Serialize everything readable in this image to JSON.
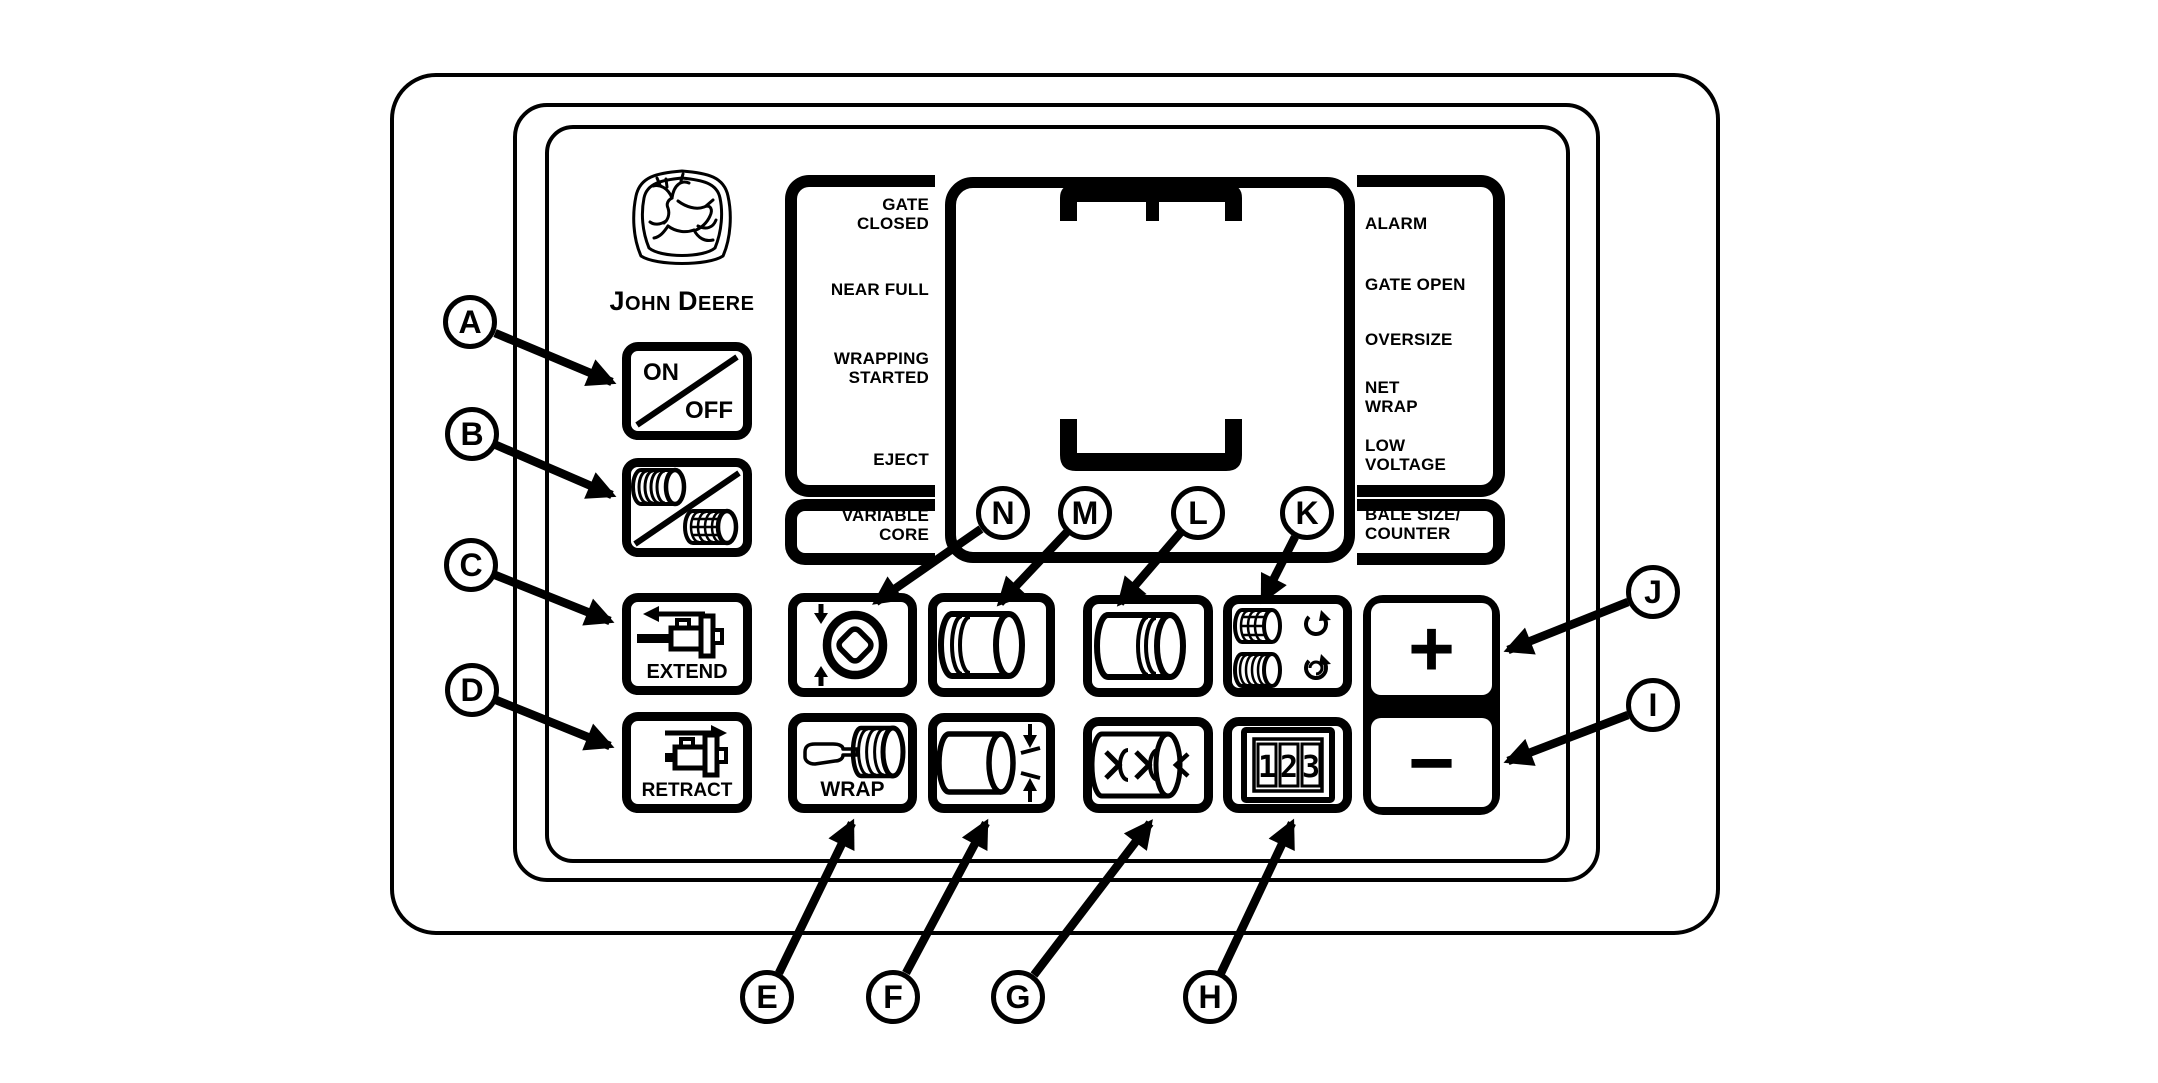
{
  "colors": {
    "ink": "#000000",
    "paper": "#ffffff"
  },
  "brand": {
    "j": "J",
    "ohn": "OHN",
    "d": "D",
    "eere": "EERE"
  },
  "status_left": {
    "gate_closed": [
      "GATE",
      "CLOSED"
    ],
    "near_full": "NEAR FULL",
    "wrapping_started": [
      "WRAPPING",
      "STARTED"
    ],
    "eject": "EJECT",
    "variable_core": [
      "VARIABLE",
      "CORE"
    ]
  },
  "status_right": {
    "alarm": "ALARM",
    "gate_open": "GATE OPEN",
    "oversize": "OVERSIZE",
    "net_wrap": [
      "NET",
      "WRAP"
    ],
    "low_voltage": [
      "LOW",
      "VOLTAGE"
    ],
    "bale_size_counter": [
      "BALE SIZE/",
      "COUNTER"
    ]
  },
  "buttons": {
    "power": {
      "on": "ON",
      "off": "OFF"
    },
    "extend": "EXTEND",
    "retract": "RETRACT",
    "wrap": "WRAP",
    "increase": "+",
    "decrease": "−",
    "counter_digits": [
      "1",
      "2",
      "3"
    ]
  },
  "callouts": {
    "a": "A",
    "b": "B",
    "c": "C",
    "d": "D",
    "e": "E",
    "f": "F",
    "g": "G",
    "h": "H",
    "i": "I",
    "j": "J",
    "k": "K",
    "l": "L",
    "m": "M",
    "n": "N"
  }
}
